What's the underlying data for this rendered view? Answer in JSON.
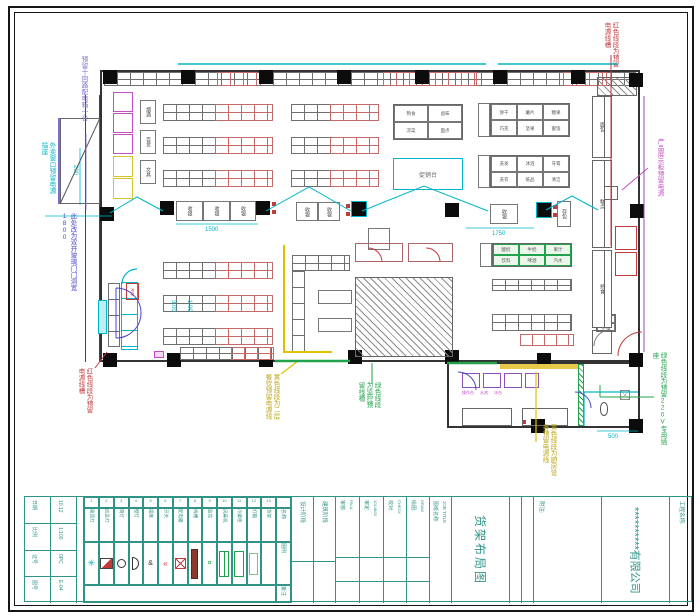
{
  "colors": {
    "ink": "#2b2b2b",
    "shelf": "#6f6f6f",
    "shelf_red": "#c46a6a",
    "red": "#c23b3b",
    "cyan": "#00b6c9",
    "magenta": "#c44fc4",
    "yellow": "#dfc010",
    "green": "#23a24d",
    "blue": "#4a47c8",
    "purple": "#8a52b8",
    "teal": "#2f9387"
  },
  "plan": {
    "labels": {
      "checkout": "收银",
      "cart_park": "存包",
      "promo": "促销台",
      "freezer": "冰柜",
      "left_wall_boxes": [
        "烟酒",
        "百货",
        "文具"
      ],
      "right_counters": [
        "面包",
        "糕点",
        "熟食"
      ],
      "pair_box": [
        "大米",
        "杂粮"
      ],
      "room_labels": [
        "操作台",
        "水池",
        "冰台"
      ]
    },
    "tables": {
      "t1": [
        [
          "熟食",
          "卤味"
        ],
        [
          "凉菜",
          "面点"
        ]
      ],
      "t2": [
        [
          "饼干",
          "薯片",
          "糖果"
        ],
        [
          "巧克",
          "坚果",
          "蜜饯"
        ]
      ],
      "t3": [
        [
          "洗发",
          "沐浴",
          "牙膏"
        ],
        [
          "洗衣",
          "纸品",
          "清洁"
        ]
      ],
      "tg": [
        [
          "酸奶",
          "牛奶",
          "果汁"
        ],
        [
          "饮料",
          "啤酒",
          "汽水"
        ]
      ]
    },
    "dims": {
      "d1": "1500",
      "d2": "1750",
      "d3": "500",
      "d4": "200",
      "d5": "3.00",
      "d6": "1.00"
    },
    "annotations": [
      {
        "text": "预留十回路配电箱一台",
        "color": "#7a6fd0"
      },
      {
        "text": "外卖窗口预留电源插座",
        "color": "#00b6c9"
      },
      {
        "text": "此处改为双开玻璃门门洞宽1800",
        "color": "#4a47c8"
      },
      {
        "text": "红色线段为预留电源线槽",
        "color": "#c23b3b"
      },
      {
        "text": "黄色线段为二层餐饮预留电源线",
        "color": "#bba414"
      },
      {
        "text": "绿色线段为监控预留线槽",
        "color": "#23a24d"
      },
      {
        "text": "黄色线段为厨房设备预留电源线",
        "color": "#bba414"
      },
      {
        "text": "绿色线段为预留220V专用插座",
        "color": "#23a24d"
      },
      {
        "text": "红色线段为预留电源线槽",
        "color": "#c23b3b"
      },
      {
        "text": "产品展示柜预留电源",
        "color": "#c44fc4"
      }
    ]
  },
  "legend": {
    "row_headers": [
      "名称",
      "图例",
      "备注"
    ],
    "items": [
      {
        "no": "1",
        "name": "吸顶灯"
      },
      {
        "no": "2",
        "name": "应急灯"
      },
      {
        "no": "3",
        "name": "筒灯"
      },
      {
        "no": "4",
        "name": "壁灯"
      },
      {
        "no": "5",
        "name": "插座"
      },
      {
        "no": "6",
        "name": "开关"
      },
      {
        "no": "7",
        "name": "配电箱"
      },
      {
        "no": "8",
        "name": "线槽"
      },
      {
        "no": "9",
        "name": "监控"
      },
      {
        "no": "10",
        "name": "风幕机"
      },
      {
        "no": "11",
        "name": "冷藏柜"
      },
      {
        "no": "12",
        "name": "灯箱"
      },
      {
        "no": "13",
        "name": "货架"
      }
    ]
  },
  "titleblock": {
    "info": [
      {
        "label": "日期",
        "value": "10.12"
      },
      {
        "label": "比例",
        "value": "1:100"
      },
      {
        "label": "证号",
        "value": "0PC"
      },
      {
        "label": "图号",
        "value": "E-04"
      }
    ],
    "stages": [
      "设计阶段",
      "建筑阶段"
    ],
    "fields": [
      {
        "label": "审核:",
        "value": "PAUL"
      },
      {
        "label": "审定:",
        "value": "1014B03"
      },
      {
        "label": "校对:",
        "value": "CHECK"
      },
      {
        "label": "绘图:",
        "value": "DRAW"
      }
    ],
    "name_label": "图纸名称:",
    "job_title": "JOB TITLE",
    "drawing_name": "货架布局图",
    "note_label": "附注:",
    "company": "**********有限公司",
    "project_label": "工程名称:"
  }
}
